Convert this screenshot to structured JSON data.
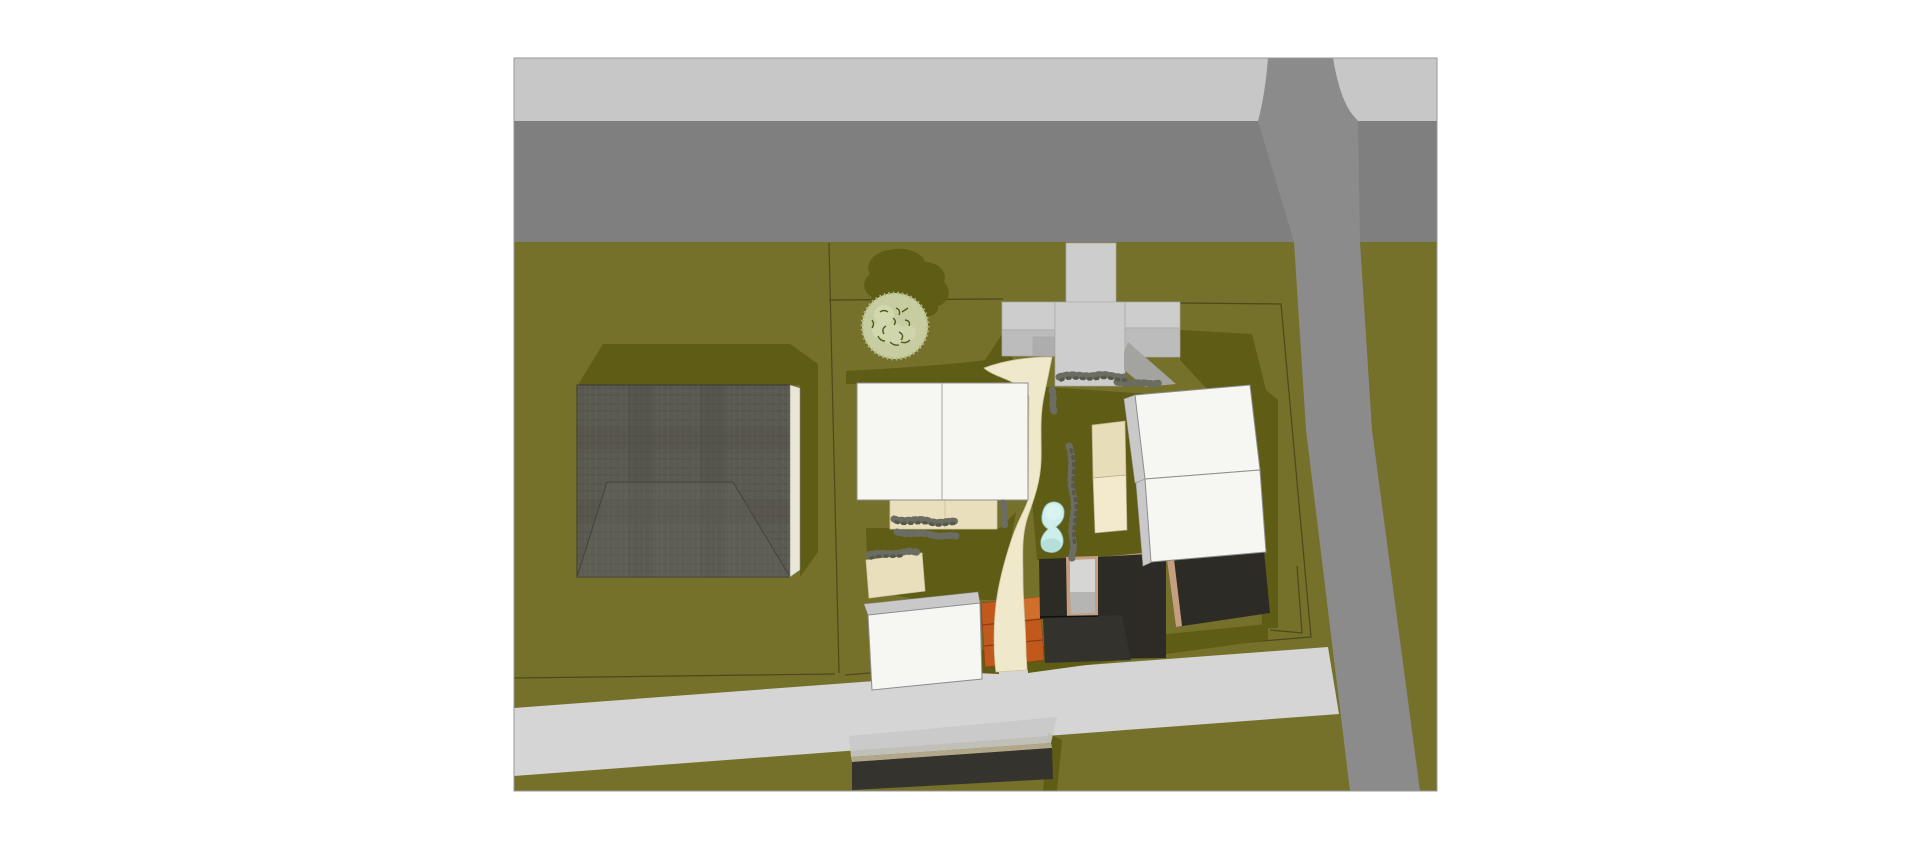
{
  "scene": {
    "kind": "aerial-site-plan-render",
    "viewport": {
      "x": 514,
      "y": 58,
      "width": 923,
      "height": 733
    },
    "objects": [
      "sidewalk",
      "main-road",
      "side-road",
      "south-road",
      "lawn",
      "parcel-boundary",
      "barn",
      "garden-tree",
      "driveway",
      "parking-court",
      "central-house",
      "garden-path",
      "terrace",
      "swimming-pool",
      "hedges",
      "orange-planters",
      "small-house",
      "tan-roof-house",
      "white-house-upper",
      "white-house-lower",
      "courtyard-buildings",
      "carport"
    ]
  },
  "colors": {
    "bg": "#ffffff",
    "viewport-border": "#9a9a9a",
    "grass": "#75702a",
    "grass-dark": "#5e5c15",
    "parcel-line": "#4c491c",
    "sidewalk": "#c7c7c7",
    "road-top": "#7f7f7f",
    "road-side": "#8b8b8b",
    "road-bottom": "#d5d5d5",
    "court": "#cdcdcd",
    "court-mid": "#bcbcbc",
    "court-step": "#adadad",
    "court-dark": "#a3a3a0",
    "cream": "#efe8ca",
    "cream-edge": "#cfc6a0",
    "terrace": "#eadfbc",
    "white-bldg": "#f6f6f3",
    "bldg-stroke": "#8d8d8d",
    "side-face": "#c9c9c9",
    "tan-upper": "#e7ddb9",
    "tan-lower": "#f3eacd",
    "tan-stroke": "#b9ad85",
    "charcoal": "#2d2b26",
    "charcoal2": "#34322c",
    "tan-edge": "#c49e7e",
    "inset-light": "#d6d6d4",
    "inset-mid": "#b5b5b3",
    "orange": "#c2591c",
    "orange-dark": "#8e3d10",
    "orange-light": "#d06f2c",
    "pool": "#cdeeea",
    "pool-deep": "#aed9d4",
    "pool-hi": "#dcf4f1",
    "pool-stroke": "#8cb8b3",
    "hedge": "#6b6d62",
    "hedge-dark": "#565849",
    "tree-base": "#c7cda1",
    "tree-light": "#d2d8ae",
    "tree-mid": "#aeb681",
    "tree-dark": "#4f5a1f",
    "barn-base": "#5a5952",
    "barn-light": "#6a695f",
    "barn-dark": "#44433c",
    "barn-side": "#eae6d7",
    "carport-roof": "#c9c9c9",
    "carport-tan": "#b2a78a",
    "carport-face": "#35332d"
  }
}
